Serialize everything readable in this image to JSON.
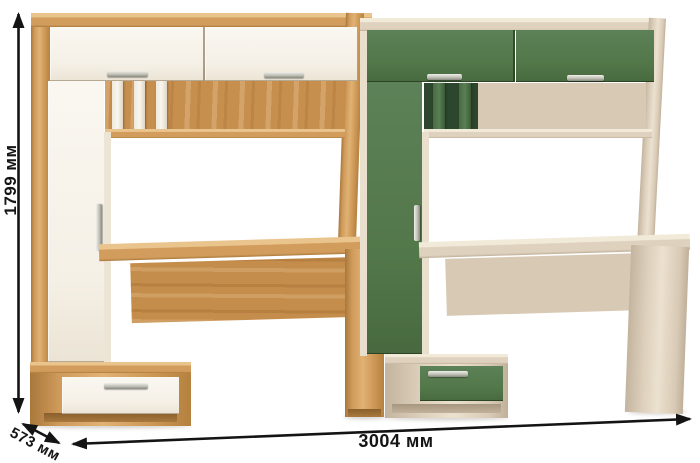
{
  "annotations": {
    "height_label": "1799 мм",
    "width_label": "3004 мм",
    "depth_label": "573 мм"
  },
  "colors": {
    "line": "#141414",
    "wood": "#cf9a5a",
    "wood-light": "#e6bd85",
    "wood-dark": "#aa7a3c",
    "white-door": "#f8f4ec",
    "green": "#527749",
    "green-deep": "#2d472e",
    "beige": "#ddd0bc",
    "beige-back": "#d7c9b4",
    "handle": "#c2c1b7"
  }
}
